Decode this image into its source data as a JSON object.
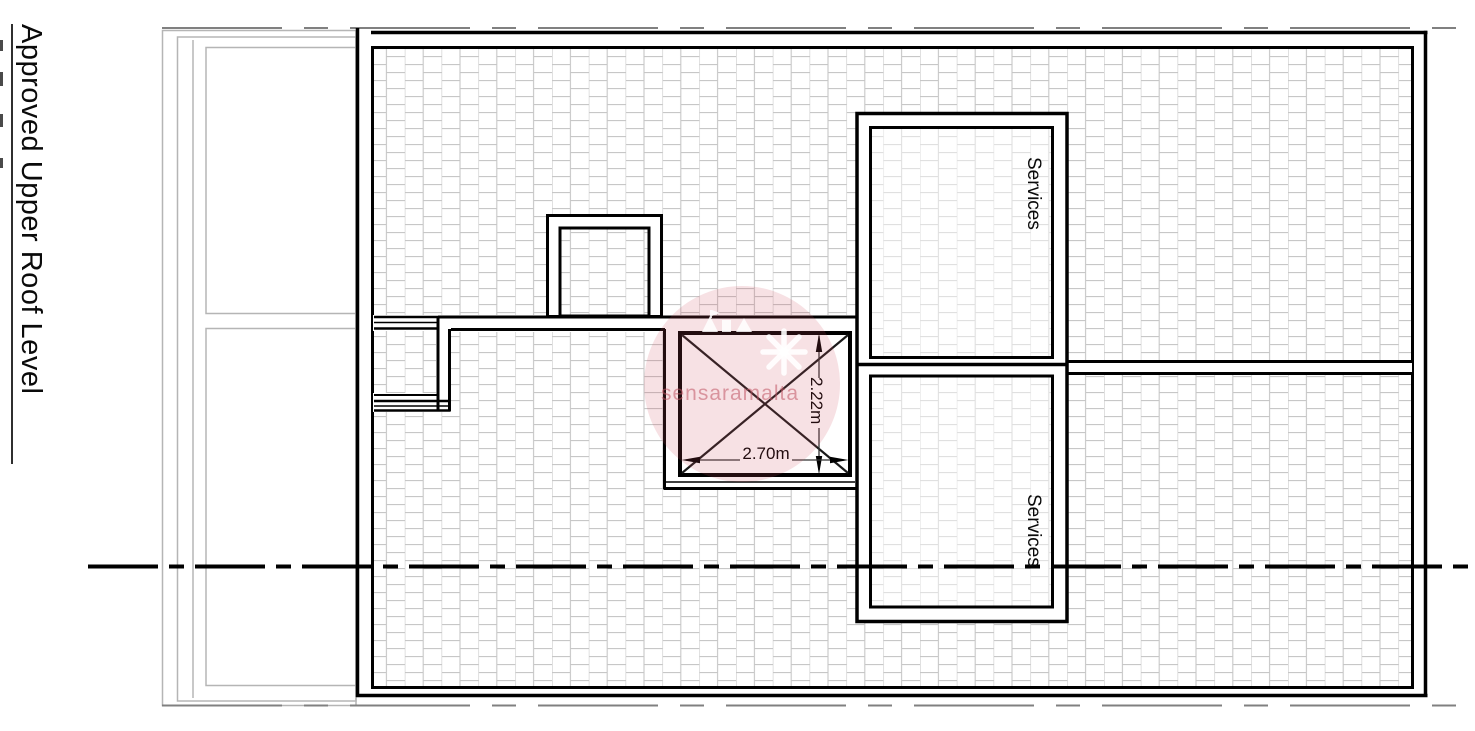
{
  "sheet": {
    "title": "Approved Upper Roof Level"
  },
  "rooms": {
    "upper_label": "Services",
    "lower_label": "Services"
  },
  "dimensions": {
    "width_label": "2.70m",
    "height_label": "2.22m"
  },
  "watermark": {
    "text": "sensaramalta"
  },
  "colors": {
    "line_black": "#000000",
    "hatch_gray": "#c7c7c7",
    "hatch_light_gray": "#d9d9d9",
    "sheet_frame_gray": "#b5b5b5",
    "border_dash_gray": "#808080",
    "watermark_pink": "#cd4b5c"
  }
}
